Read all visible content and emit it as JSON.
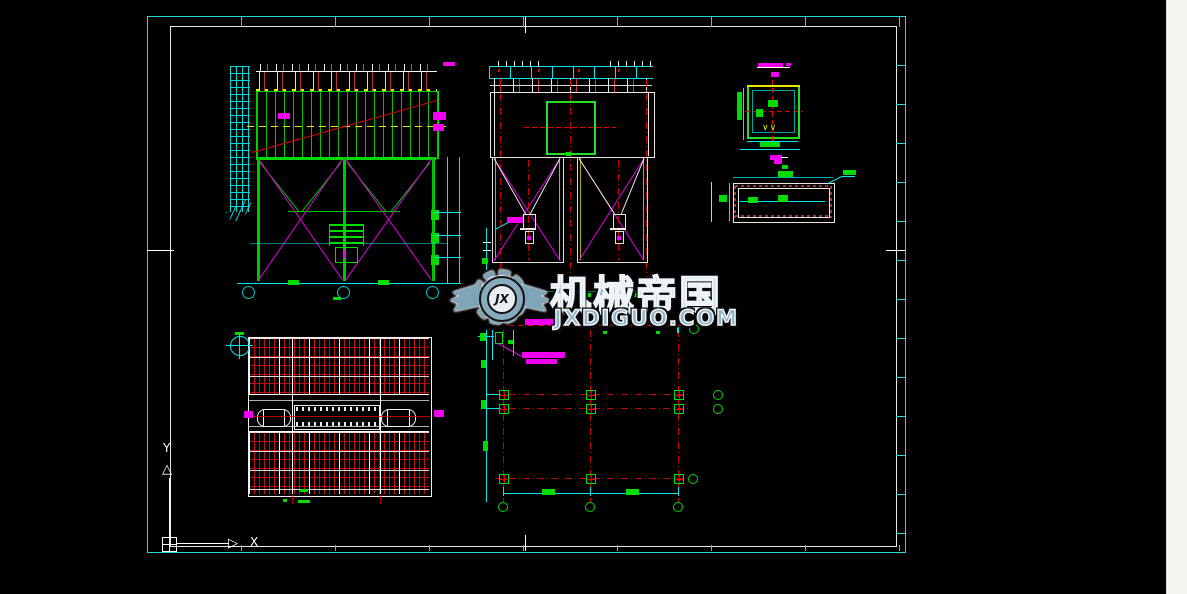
{
  "watermark": {
    "brand": "机械帝国",
    "domain": "JXDIGUO.COM",
    "monogram": "JX"
  },
  "ucs": {
    "x_label": "X",
    "y_label": "Y"
  },
  "scrollbar": {
    "up_glyph": "▲",
    "down_glyph": "▼"
  },
  "details": {
    "weld_symbol": "∨∨"
  },
  "colors": {
    "frame_cyan": "#2bd8d8",
    "entity_green": "#00dc00",
    "brace_magenta": "#f000f0",
    "centerline_red": "#e00000",
    "dim_cyan": "#00e8e8",
    "annotation_yellow": "#e8e800",
    "entity_white": "#e8e8e8",
    "watermark_steel": "#8fb3c4",
    "scroll_track": "#f5f4ee",
    "bolt_dark_red": "#a03838",
    "background": "#000000"
  }
}
